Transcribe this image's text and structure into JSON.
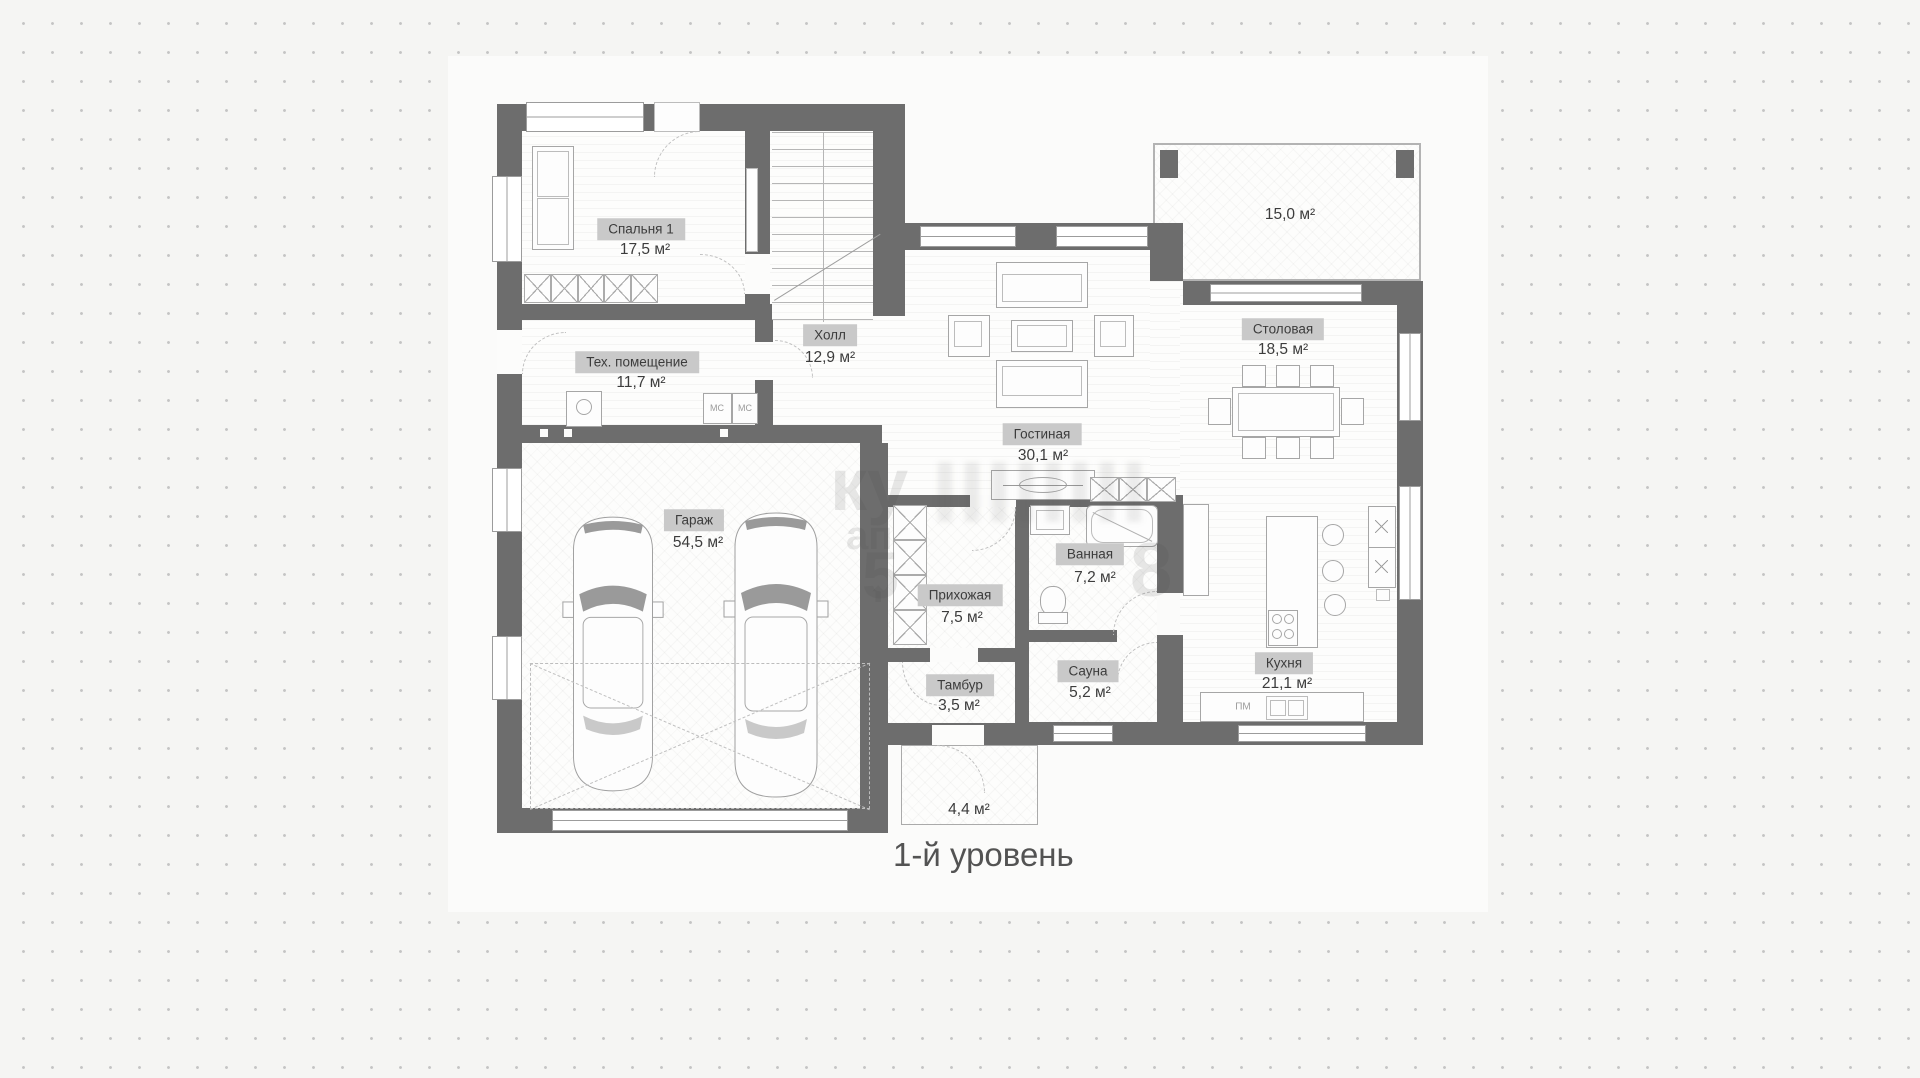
{
  "plan": {
    "title": "1-й уровень",
    "rooms": [
      {
        "id": "bedroom",
        "name": "Спальня 1",
        "area": "17,5 м²"
      },
      {
        "id": "tech",
        "name": "Тех. помещение",
        "area": "11,7 м²"
      },
      {
        "id": "hall",
        "name": "Холл",
        "area": "12,9 м²"
      },
      {
        "id": "living",
        "name": "Гостиная",
        "area": "30,1 м²"
      },
      {
        "id": "dining",
        "name": "Столовая",
        "area": "18,5 м²"
      },
      {
        "id": "garage",
        "name": "Гараж",
        "area": "54,5 м²"
      },
      {
        "id": "entryhall",
        "name": "Прихожая",
        "area": "7,5 м²"
      },
      {
        "id": "bathroom",
        "name": "Ванная",
        "area": "7,2 м²"
      },
      {
        "id": "sauna",
        "name": "Сауна",
        "area": "5,2 м²"
      },
      {
        "id": "vestibule",
        "name": "Тамбур",
        "area": "3,5 м²"
      },
      {
        "id": "kitchen",
        "name": "Кухня",
        "area": "21,1 м²"
      }
    ],
    "open_areas": {
      "terrace_area": "15,0 м²",
      "porch_area": "4,4 м²"
    },
    "equipment_marks": {
      "washing_machine": "МС",
      "dishwasher": "ПМ"
    },
    "watermark_fragments": [
      "ку",
      "ап",
      "5",
      "8",
      "⬆"
    ],
    "colors": {
      "wall": "#6d6d6d",
      "label_bg": "#c9c9c9",
      "label_text": "#3c3c3c",
      "paper": "#fbfbfa",
      "background": "#f5f5f3",
      "dot": "#c4c4c4"
    }
  }
}
